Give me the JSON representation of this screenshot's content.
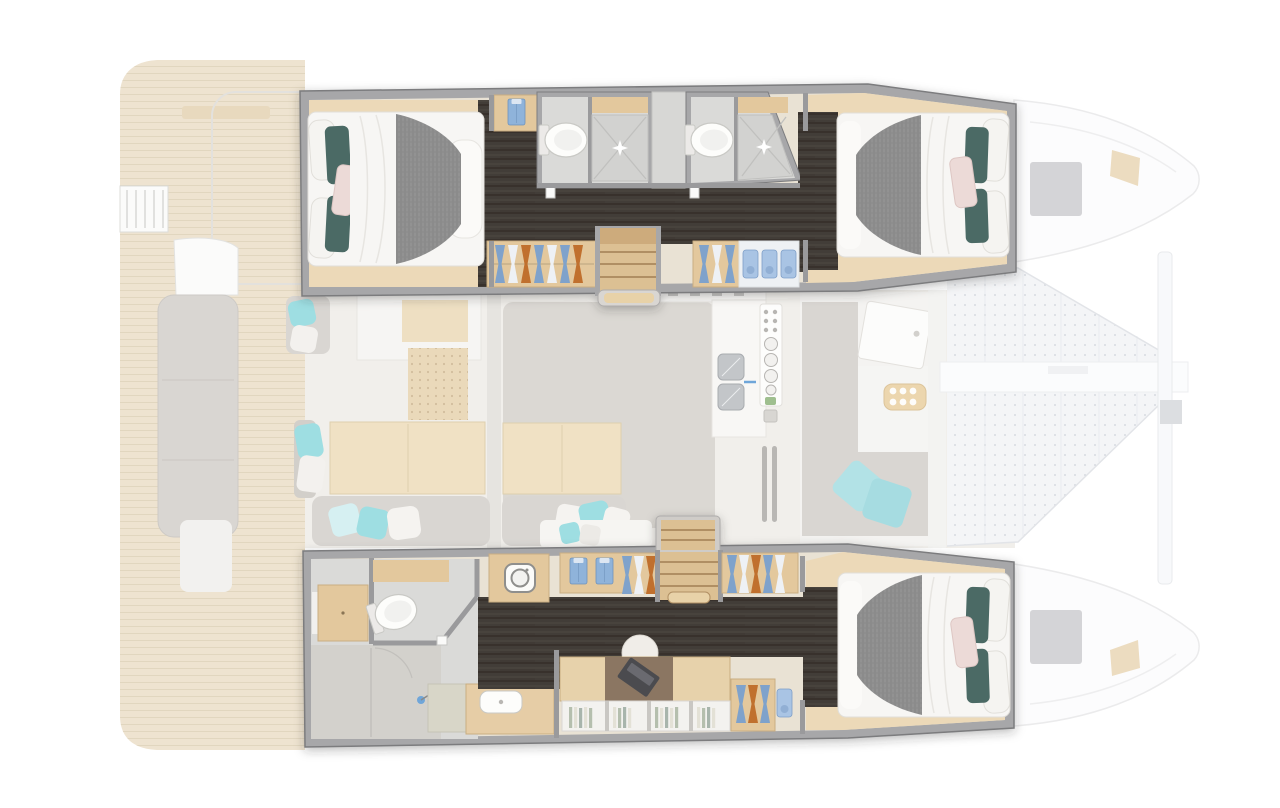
{
  "meta": {
    "subject": "catamaran-yacht-interior-floor-plan-top-view",
    "view": "top-down",
    "canvas": {
      "width": 1280,
      "height": 808
    }
  },
  "palette": {
    "pageBg": "#ffffff",
    "wall": "#a7a7a9",
    "wallEdge": "#7b7c7e",
    "wallInner": "#9a9a9c",
    "planBase": "#e9e2d4",
    "darkFloor": "#433d37",
    "cabinWood": "#ecd9b8",
    "lockerWood": "#e3c89d",
    "lockerEdge": "#c9ae82",
    "stairWood": "#dcc093",
    "stairLanding": "#cdab7c",
    "stairTread": "#b08f63",
    "stairHandle": "#e8d2a8",
    "bathFloor": "#dadad8",
    "bathFloor2": "#d3d1cc",
    "showerTray": "#d2d2d0",
    "showerLine": "#c0c0be",
    "showerGreen": "#d8d6c8",
    "fixture": "#fdfdfb",
    "fixtureEdge": "#c9c9c5",
    "fixtureInner": "#f1f1ef",
    "tank": "#eceae8",
    "sheet": "#f7f6f4",
    "mattress": "#fbfaf8",
    "duvet": "#8e8e8e",
    "bedEdge": "#e1dfda",
    "pillowTeal": "#4c6a65",
    "pillowPink": "#ecdad7",
    "pillowPinkEdge": "#ddc6c3",
    "pillowWhite": "#f5f4f1",
    "clothesBlue": "#7fa2cb",
    "clothesWhite": "#eef1f5",
    "clothesOrange": "#c06f2e",
    "shirtBlue": "#8fb3da",
    "shirtCollar": "#dce6f2",
    "towelBlue": "#a9c4e4",
    "towelEdge": "#7e9ec7",
    "deskMat": "#8b7662",
    "laptop": "#4b4c50",
    "laptopKey": "#6a6b70",
    "chair": "#f0ede8",
    "chairEdge": "#ddd9d2",
    "shelfWhite": "#f3f2ef",
    "shelfEdge": "#d9d7d3",
    "bookSage": "#b5bfae",
    "bookCream": "#e3e1d6",
    "bookGray": "#a8b5ac",
    "teak": "#eee3d0",
    "fadedWhite": "#fbfbfa",
    "fadedGray": "#d9d6d2",
    "fadedEdge": "#e3e1dd",
    "fadedFloor": "#f1efeb",
    "fadedWood": "#f0e1c4",
    "fadedWoodEdge": "#decfae",
    "salonGray": "#dbd8d3",
    "mullion": "#e6e4e0",
    "aqua": "#9edee2",
    "aquaLight": "#b2e2e6",
    "counter": "#f8f7f5",
    "counterEdge": "#e7e5e1",
    "sinkSteel": "#c3c6c9",
    "sinkEdge": "#a9acb0",
    "faucetBlue": "#6fa6d9",
    "ventGray": "#b9b7b4",
    "greenBtn": "#9fbf8f",
    "knobGray": "#d8d6d2",
    "handleGray": "#c9c8c6",
    "net": "#f4f5f7",
    "netEdge": "#e2e4e8",
    "beam": "#fbfcfd",
    "beamEdge": "#eceef0",
    "nose": "#fcfcfd",
    "noseEdge": "#ebebec",
    "hatchGray": "#cccdd0",
    "chipBeige": "#ecdcc0",
    "washerEdge": "#8f8f8d",
    "protrusion": "#d9d6d2",
    "protrusionEdge": "#aeacab"
  },
  "semantics": {
    "vessel": "catamaran",
    "decks": {
      "port_hull_top": [
        "aft-guest-cabin-double-bed",
        "wardrobe-with-folded-shirt",
        "shower-room-1-toilet-and-shower",
        "shower-room-2-toilet-and-shower",
        "companionway-stairs",
        "hanging-lockers",
        "shelf-with-towels",
        "forward-guest-cabin-double-bed"
      ],
      "main_deck_faded": [
        "aft-cockpit-teak-deck",
        "stern-ladder-platform",
        "cockpit-bench",
        "saloon-two-tables-with-sofas",
        "chart-area",
        "galley-sink-and-cooktop",
        "forward-cockpit-lounge-with-table",
        "trampoline-nets",
        "bow-crossbeam",
        "deck-hatches"
      ],
      "starboard_hull_bottom": [
        "owner-bathroom-toilet-and-shower",
        "storage-cabinet",
        "washing-machine",
        "vanity-basin",
        "companionway-stairs",
        "hanging-lockers-and-folded-shirts",
        "desk-with-laptop-and-chair",
        "bookshelf",
        "forward-owner-cabin-double-bed"
      ]
    },
    "counts": {
      "double_beds": 3,
      "shower_rooms": 3,
      "toilets": 3,
      "staircases": 2,
      "trampolines": 2
    }
  }
}
